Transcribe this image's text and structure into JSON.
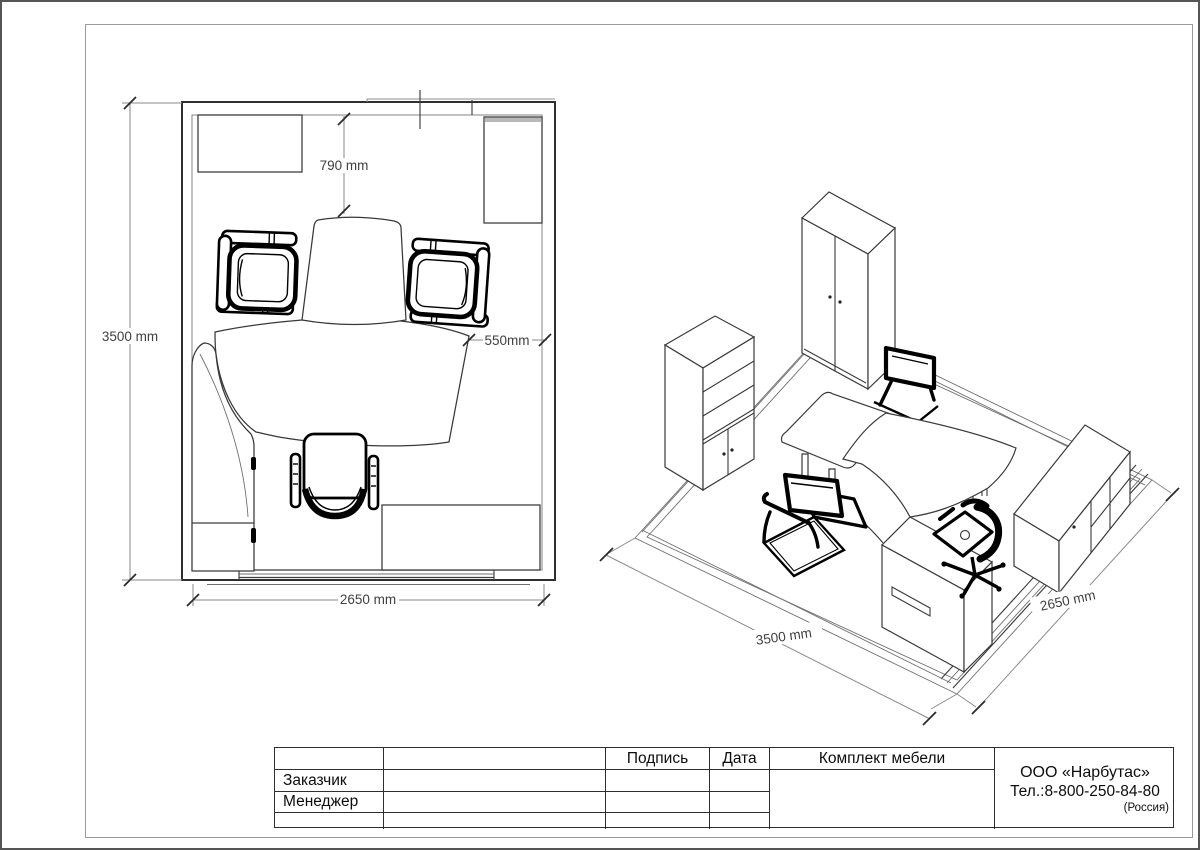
{
  "plan": {
    "dim_room_height": "3500 mm",
    "dim_room_width": "2650 mm",
    "dim_table_offset": "790 mm",
    "dim_desk_clearance": "550mm"
  },
  "iso": {
    "dim_room_height": "3500 mm",
    "dim_room_width": "2650 mm"
  },
  "title_block": {
    "signature_header": "Подпись",
    "date_header": "Дата",
    "set_header": "Комплект мебели",
    "customer_label": "Заказчик",
    "manager_label": "Менеджер",
    "company_name": "ООО «Нарбутас»",
    "company_phone": "Тел.:8-800-250-84-80",
    "company_country": "(Россия)"
  }
}
